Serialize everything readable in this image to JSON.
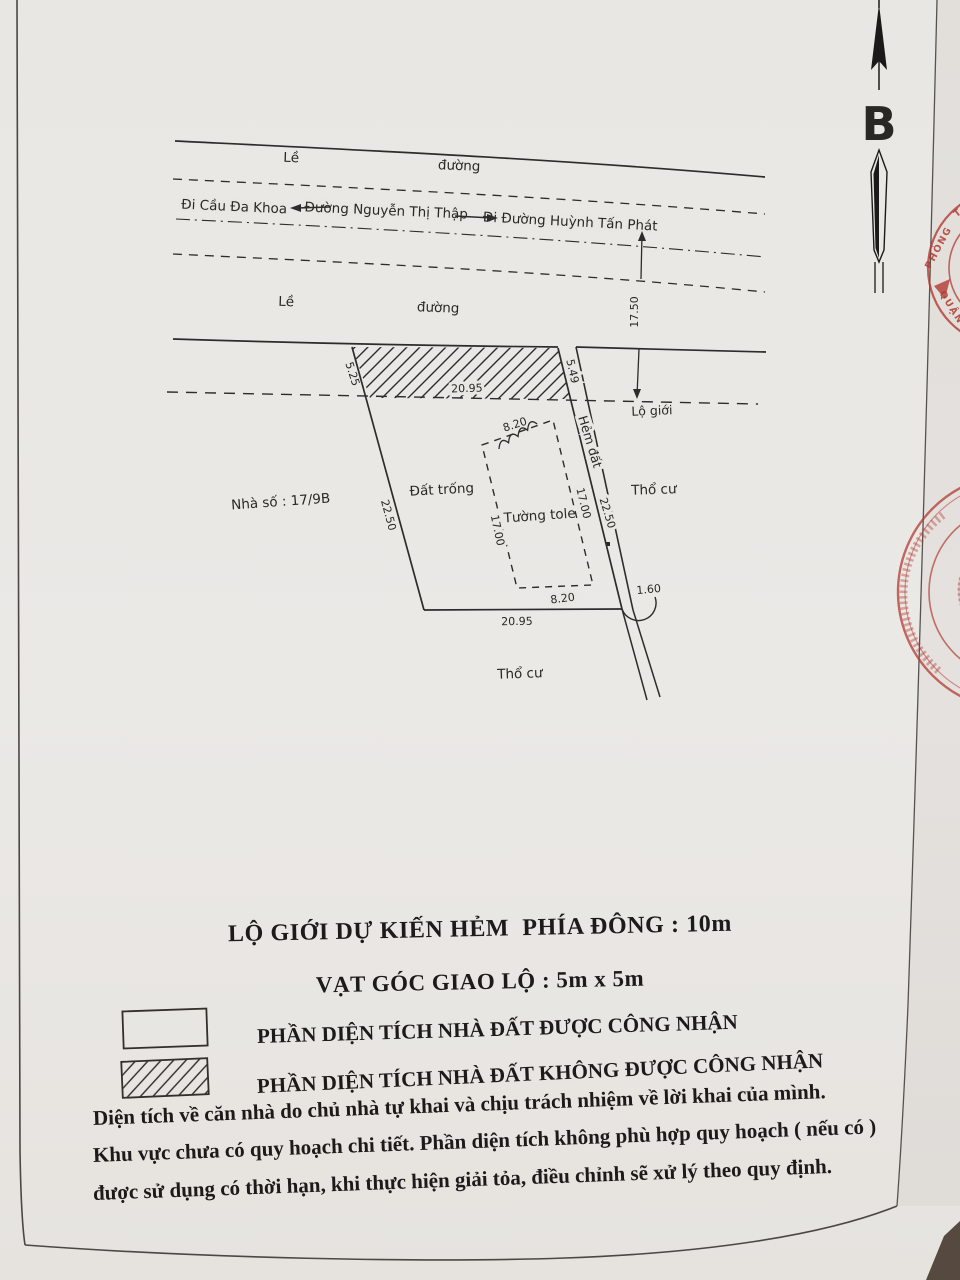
{
  "colors": {
    "ink": "#2a2825",
    "stamp_red": "#b23a32",
    "paper": "#e9e7e3"
  },
  "compass": {
    "north_label": "B"
  },
  "road": {
    "sidewalk_top": "Lề",
    "carriageway_top": "đường",
    "dir_left": "Đi Cầu Đa Khoa",
    "name": "Đường Nguyễn Thị Thập",
    "dir_right": "Đi Đường Huỳnh Tấn Phát",
    "sidewalk_bottom": "Lề",
    "carriageway_bottom": "đường",
    "halfwidth_dim": "17.50",
    "boundary_label": "Lộ giới"
  },
  "plot": {
    "house_no": "Nhà số : 17/9B",
    "vacant_label": "Đất trống",
    "wall_label": "Tường tole",
    "alley_label": "Hẻm đất",
    "residential_right": "Thổ cư",
    "residential_bottom": "Thổ cư",
    "dim_top": "20.95",
    "dim_bottom": "20.95",
    "dim_left": "22.50",
    "dim_alley": "22.50",
    "dim_hatch_left": "5.25",
    "dim_hatch_right": "5.49",
    "dim_wall_top": "8.20",
    "dim_wall_bottom": "8.20",
    "dim_wall_left": "17.00",
    "dim_wall_right": "17.00",
    "dim_corner": "1.60"
  },
  "captions": {
    "line1": "LỘ GIỚI DỰ KIẾN HẺM  PHÍA ĐÔNG : 10m",
    "line2": "VẠT GÓC GIAO LỘ : 5m x 5m"
  },
  "legend": {
    "recognized": "PHẦN DIỆN TÍCH NHÀ ĐẤT ĐƯỢC CÔNG NHẬN",
    "not_recognized": "PHẦN DIỆN TÍCH NHÀ ĐẤT KHÔNG ĐƯỢC CÔNG NHẬN"
  },
  "notes": {
    "line1": "Diện tích về căn nhà do chủ nhà tự khai và chịu trách nhiệm về lời khai của mình.",
    "line2": "Khu vực chưa có quy hoạch chi tiết. Phần diện tích không phù hợp quy hoạch ( nếu có )",
    "line3": "được sử dụng có thời hạn, khi thực hiện giải tỏa, điều chỉnh sẽ xử lý theo quy định."
  },
  "stamps": {
    "top_arc_text_1": "PHÒNG",
    "top_arc_text_2": "TÀI",
    "top_arc_text_3": "QUẬN"
  }
}
